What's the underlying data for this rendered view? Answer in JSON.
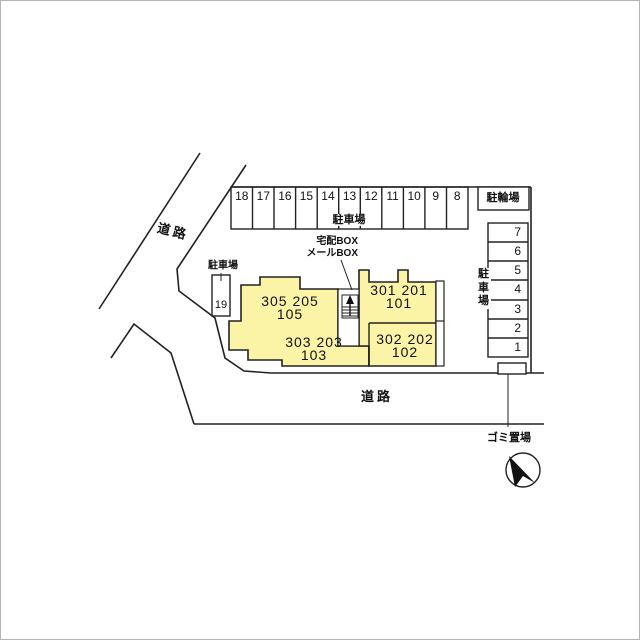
{
  "colors": {
    "building_fill": "#FBF3A6",
    "line_color": "#222222",
    "background": "#FFFFFF"
  },
  "roads": {
    "top_left_label": "道路",
    "bottom_label": "道路"
  },
  "parking_top": {
    "area_label": "駐車場",
    "spaces": [
      "18",
      "17",
      "16",
      "15",
      "14",
      "13",
      "12",
      "11",
      "10",
      "9",
      "8"
    ]
  },
  "parking_right": {
    "area_label_chars": [
      "駐",
      "車",
      "場"
    ],
    "spaces": [
      "7",
      "6",
      "5",
      "4",
      "3",
      "2",
      "1"
    ]
  },
  "parking_west": {
    "area_label": "駐車場",
    "space": "19"
  },
  "bicycle_parking": {
    "label": "駐輪場"
  },
  "garbage": {
    "label": "ゴミ置場"
  },
  "delivery": {
    "line1": "宅配BOX",
    "line2": "メールBOX"
  },
  "building_west": {
    "upper_line1": "305 205",
    "upper_line2": "105",
    "lower_line1": "303 203",
    "lower_line2": "103"
  },
  "building_east": {
    "upper_line1": "301 201",
    "upper_line2": "101",
    "lower_line1": "302 202",
    "lower_line2": "102"
  }
}
